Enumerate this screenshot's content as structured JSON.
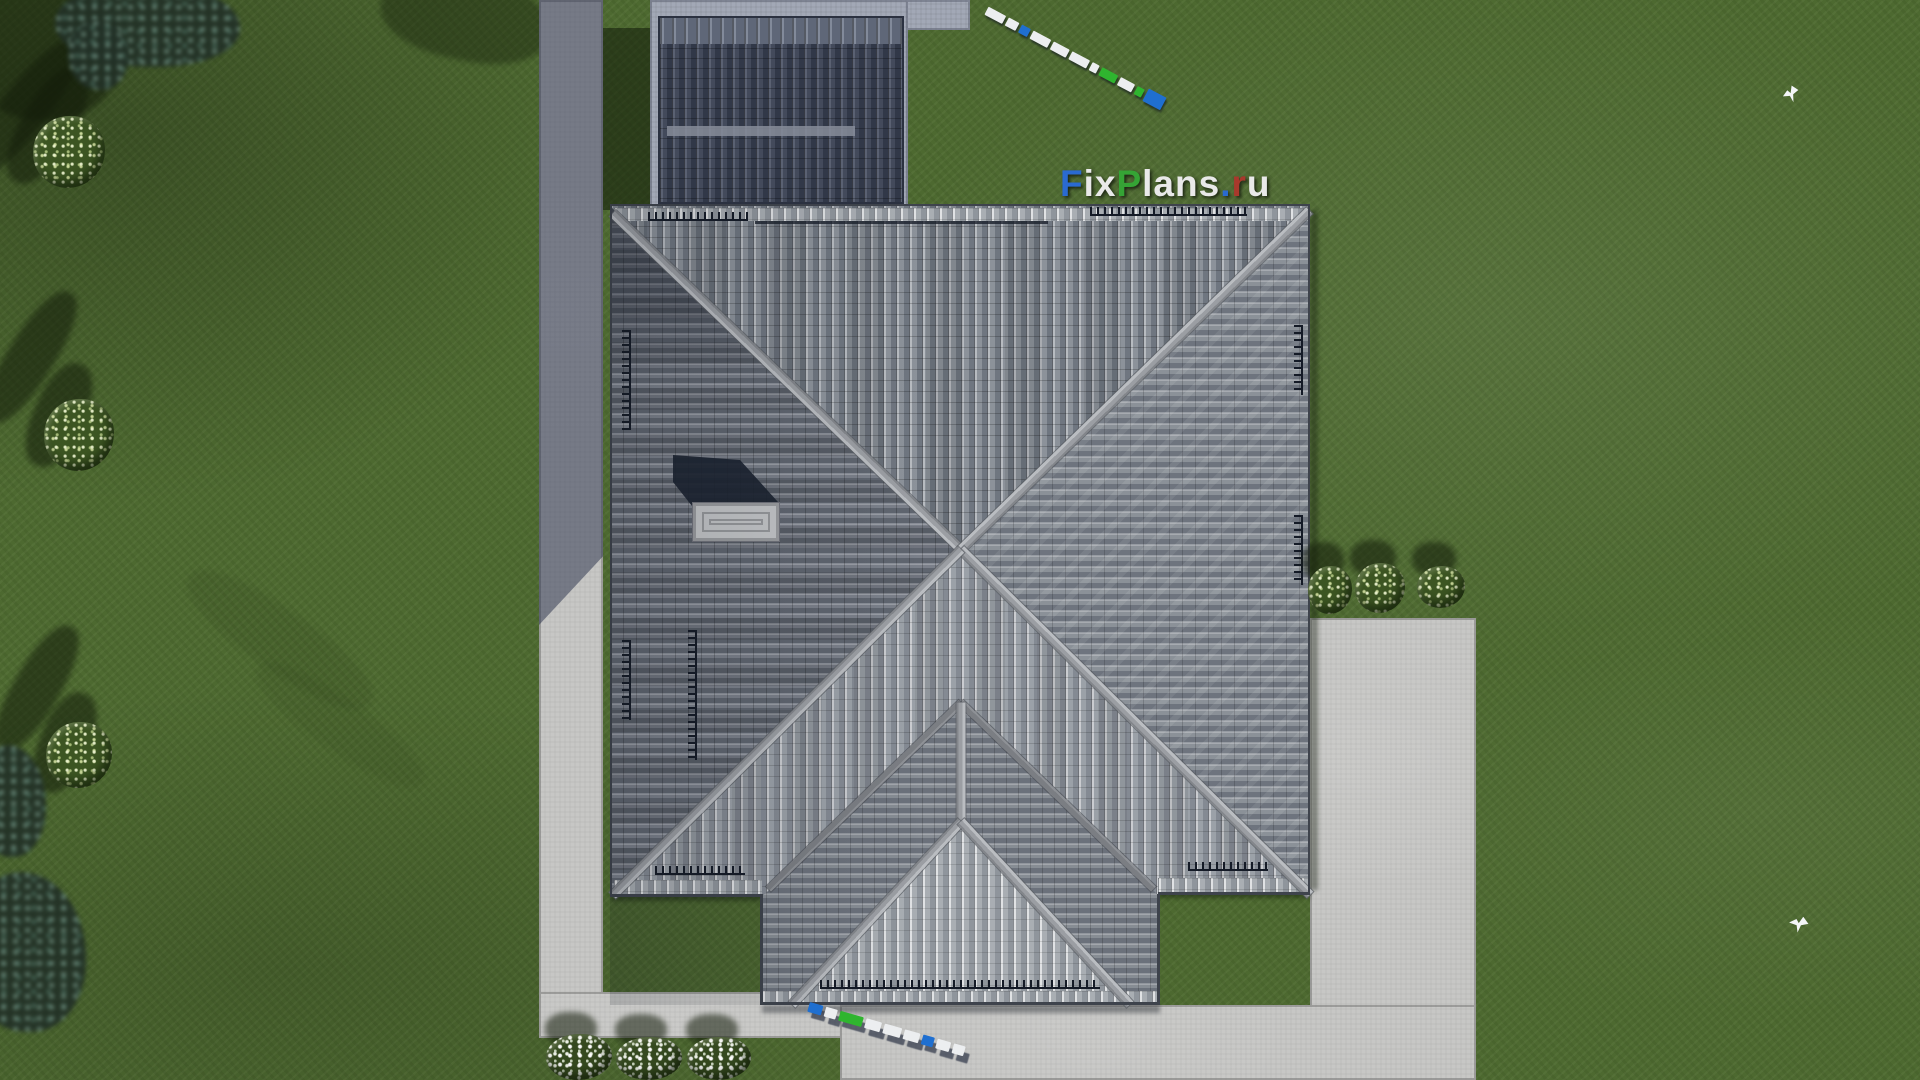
{
  "watermark": {
    "text": "FixPlans.ru",
    "letters": [
      {
        "ch": "F",
        "color": "#2a6ad0"
      },
      {
        "ch": "ix",
        "color": "#e9e9e9"
      },
      {
        "ch": "P",
        "color": "#35a435"
      },
      {
        "ch": "lans",
        "color": "#e9e9e9"
      },
      {
        "ch": ".",
        "color": "#2a6ad0"
      },
      {
        "ch": "r",
        "color": "#a8392c"
      },
      {
        "ch": "u",
        "color": "#e9e9e9"
      }
    ]
  },
  "scene": {
    "description": "Aerial top-down 3D architectural render: house with gray hipped tile roof, dark shadowed garage roof, concrete walkways and terrace on a green lawn with bushes, trees, white flower beds and two white birds",
    "colors": {
      "grass": "#4d6930",
      "grass_shadow": "#24351a",
      "concrete_light": "#c7c7c5",
      "concrete_shadowed": "#a2a8b6",
      "roof_tile_light": "#9ba1a8",
      "roof_tile_dark": "#3b4252",
      "ridge_cap": "#a8abaf",
      "scalebar_blue": "#1f6fd0",
      "scalebar_green": "#2fb52f",
      "scalebar_white": "#eceef0",
      "flower_white": "#f4f6f2"
    }
  }
}
